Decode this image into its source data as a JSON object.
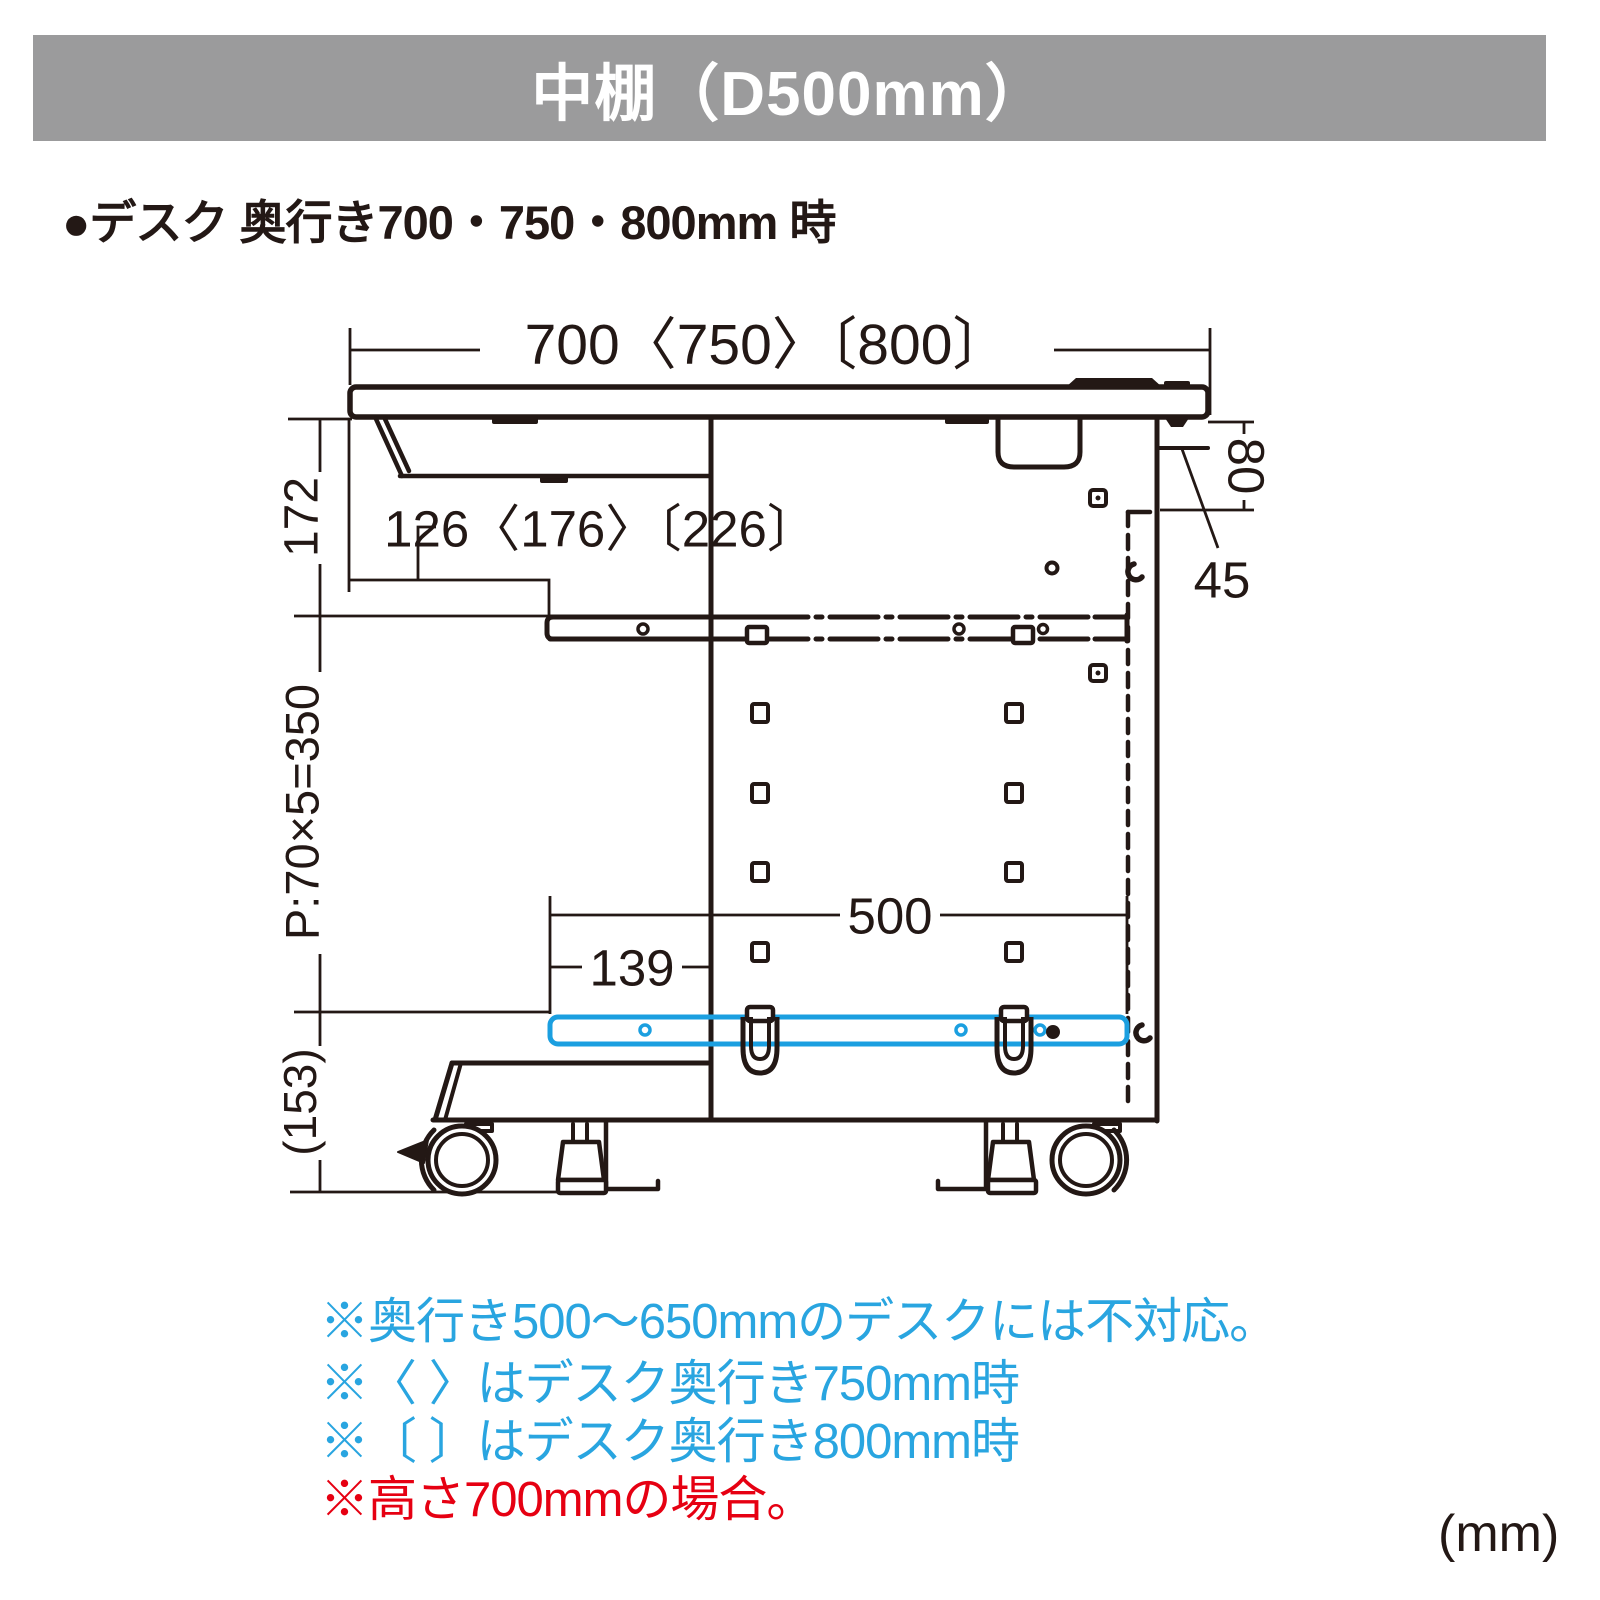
{
  "header": {
    "title": "中棚（D500mm）"
  },
  "subtitle": "●デスク 奥行き700・750・800mm 時",
  "diagram": {
    "type": "technical-dimension-drawing",
    "subject": "desk side view with middle shelf",
    "dims": {
      "desk_depth": "700〈750〉〔800〕",
      "rear_gap": "126〈176〉〔226〕",
      "top_to_shelf_rail": "172",
      "hole_pitch": "P:70×5=350",
      "lowest_to_floor": "(153)",
      "bracket_height": "80",
      "rear_edge_offset": "45",
      "shelf_depth": "500",
      "shelf_front_offset": "139"
    },
    "colors": {
      "line": "#231815",
      "highlight_shelf": "#1b9fe0"
    }
  },
  "notes": [
    {
      "text": "※奥行き500〜650mmのデスクには不対応。",
      "color": "#29a5e0"
    },
    {
      "text": "※〈 〉はデスク奥行き750mm時",
      "color": "#29a5e0"
    },
    {
      "text": "※〔 〕はデスク奥行き800mm時",
      "color": "#29a5e0"
    },
    {
      "text": "※高さ700mmの場合。",
      "color": "#e60012"
    }
  ],
  "unit_label": "(mm)"
}
